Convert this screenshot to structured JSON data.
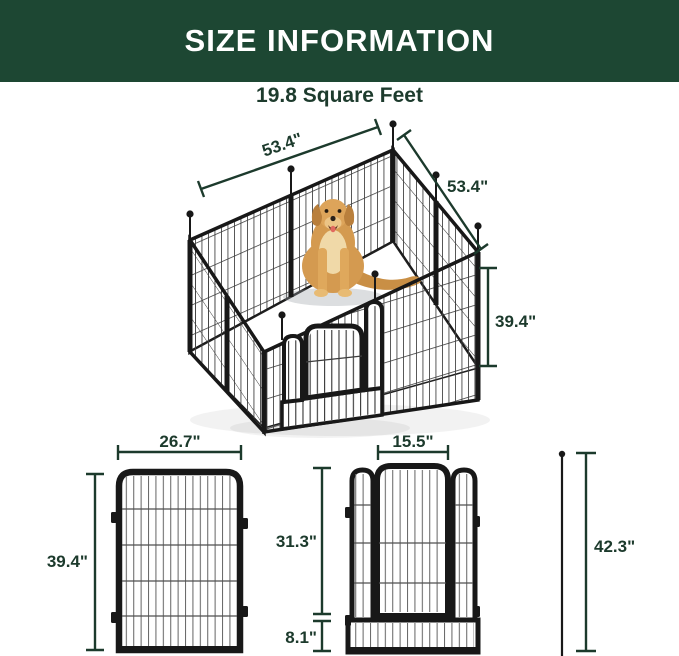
{
  "header": {
    "title": "SIZE INFORMATION"
  },
  "subtitle": "19.8 Square Feet",
  "hero_diagram": {
    "description": "isometric-playpen-with-dog",
    "width_label": "53.4\"",
    "depth_label": "53.4\"",
    "height_label": "39.4\""
  },
  "panel_diagram": {
    "description": "single-panel-front-view",
    "width_label": "26.7\"",
    "height_label": "39.4\""
  },
  "door_diagram": {
    "description": "door-panel-front-view",
    "door_width_label": "15.5\"",
    "upper_height_label": "31.3\"",
    "lower_height_label": "8.1\"",
    "rod_length_label": "42.3\""
  },
  "colors": {
    "banner_green": "#1d4733",
    "dimension_green": "#1c3a2c",
    "subtitle_green": "#1d3b2d",
    "frame_black": "#181818",
    "wire_gray": "#4f4f4f",
    "dog_gold": "#d49a50",
    "floor_white": "#ffffff"
  }
}
